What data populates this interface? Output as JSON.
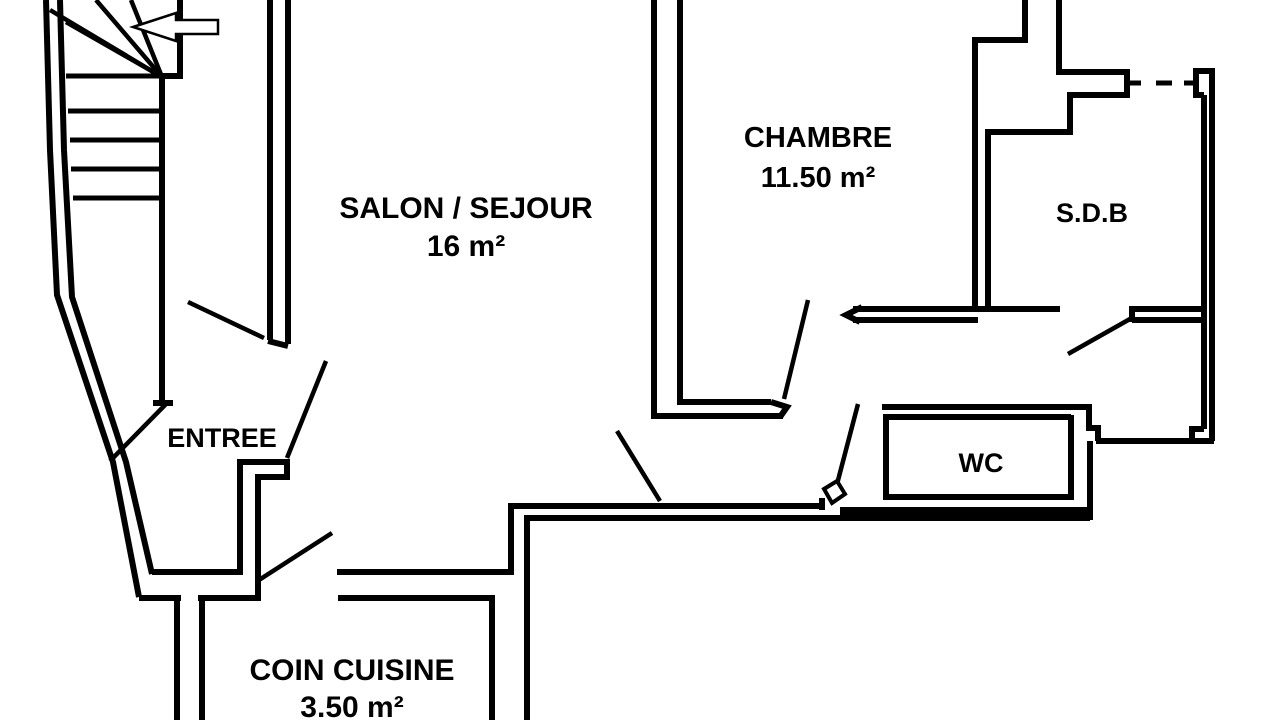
{
  "colors": {
    "background": "#ffffff",
    "wall": "#000000",
    "text": "#000000"
  },
  "rooms": [
    {
      "id": "salon",
      "label": "SALON / SEJOUR",
      "area": "16 m²"
    },
    {
      "id": "chambre",
      "label": "CHAMBRE",
      "area": "11.50 m²"
    },
    {
      "id": "sdb",
      "label": "S.D.B",
      "area": ""
    },
    {
      "id": "entree",
      "label": "ENTREE",
      "area": ""
    },
    {
      "id": "wc",
      "label": "WC",
      "area": ""
    },
    {
      "id": "cuisine",
      "label": "COIN CUISINE",
      "area": "3.50 m²"
    }
  ],
  "icons": [
    {
      "name": "entry-direction-arrow-icon",
      "shape": "outline arrow pointing left"
    }
  ]
}
